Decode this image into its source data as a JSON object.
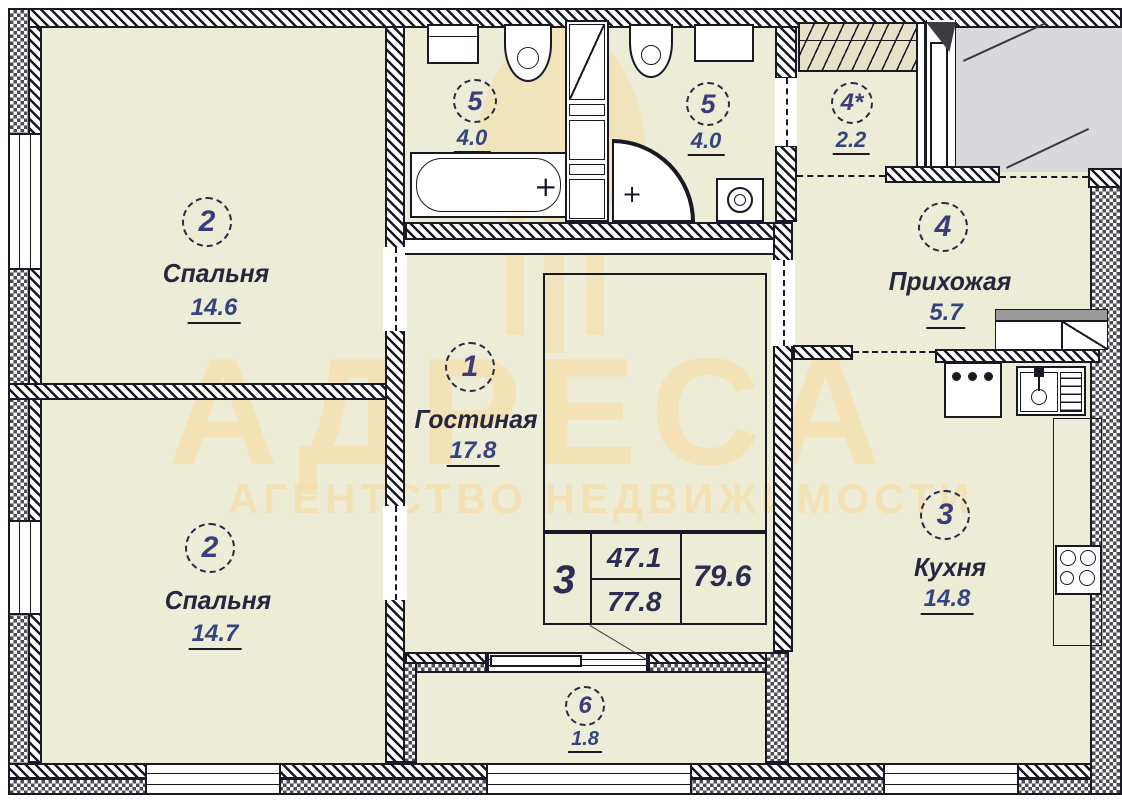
{
  "watermark": {
    "brand": "АДРЕСА",
    "tagline": "АГЕНТСТВО НЕДВИЖИМОСТИ"
  },
  "rooms": [
    {
      "id": "bedroom-top",
      "number": "2",
      "name": "Спальня",
      "area": "14.6"
    },
    {
      "id": "bathroom-left",
      "number": "5",
      "name": "",
      "area": "4.0"
    },
    {
      "id": "bathroom-right",
      "number": "5",
      "name": "",
      "area": "4.0"
    },
    {
      "id": "wardrobe",
      "number": "4*",
      "name": "",
      "area": "2.2"
    },
    {
      "id": "hallway",
      "number": "4",
      "name": "Прихожая",
      "area": "5.7"
    },
    {
      "id": "living-room",
      "number": "1",
      "name": "Гостиная",
      "area": "17.8"
    },
    {
      "id": "bedroom-bottom",
      "number": "2",
      "name": "Спальня",
      "area": "14.7"
    },
    {
      "id": "kitchen",
      "number": "3",
      "name": "Кухня",
      "area": "14.8"
    },
    {
      "id": "balcony",
      "number": "6",
      "name": "",
      "area": "1.8"
    }
  ],
  "summary_table": {
    "rooms_count": "3",
    "living_area": "47.1",
    "total_area": "77.8",
    "area_with_balcony": "79.6"
  },
  "symbols": {
    "tap_plus": "+"
  },
  "colors": {
    "room_fill": "#edecd6",
    "lobby_fill": "#d9d9db",
    "watermark": "#f4dfac",
    "line": "#191926",
    "label_text": "#26263e",
    "area_text": "#35457f"
  }
}
